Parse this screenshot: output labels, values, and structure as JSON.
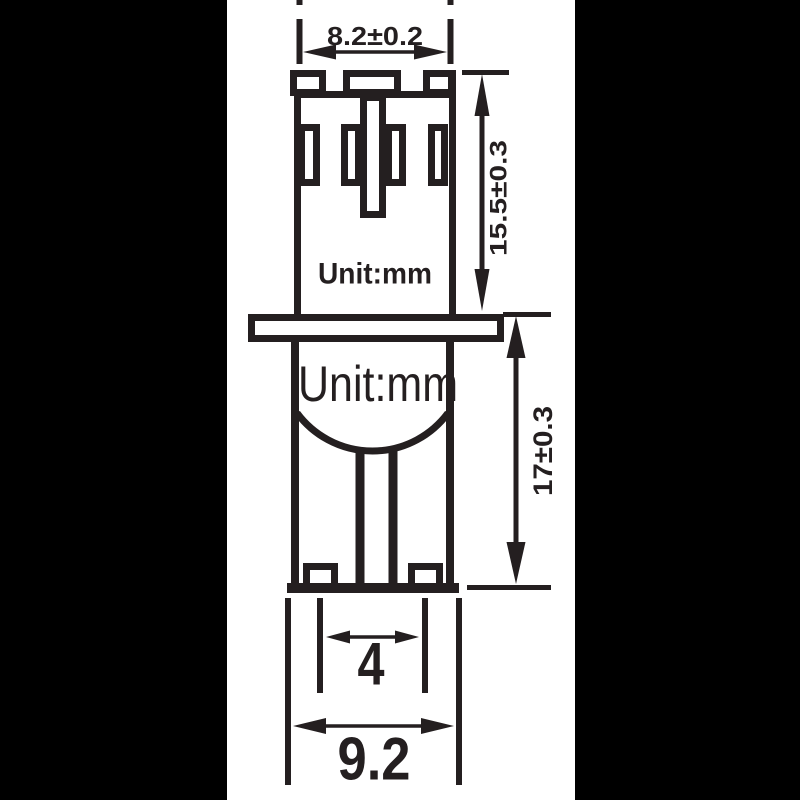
{
  "colors": {
    "background": "#000000",
    "paper": "#ffffff",
    "ink": "#241f20"
  },
  "drawing": {
    "type": "engineering-dimension-drawing",
    "subject": "T10 wedge base bulb, side elevation",
    "unit_label_base": "Unit:mm",
    "unit_label_glass": "Unit:mm",
    "dimensions": {
      "top_width": "8.2±0.2",
      "base_height": "15.5±0.3",
      "glass_height": "17±0.3",
      "contact_spacing": "4",
      "glass_width": "9.2"
    }
  }
}
